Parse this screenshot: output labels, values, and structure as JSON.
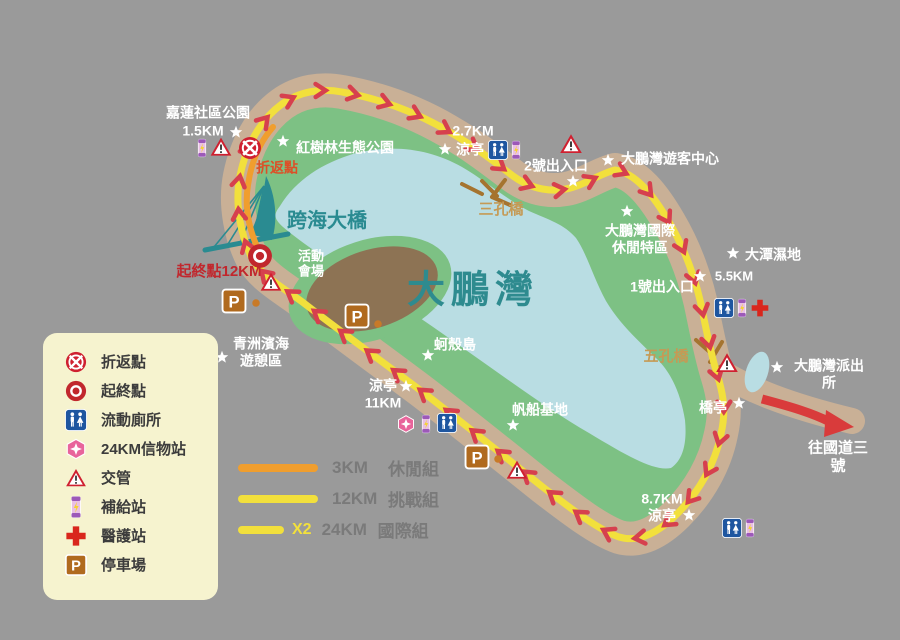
{
  "map": {
    "title": "大鵬灣",
    "colors": {
      "background": "#9a9a9a",
      "road": "#c9b096",
      "land": "#7dc184",
      "water": "#b9dde3",
      "route_12km": "#f2e03c",
      "route_3km": "#f09e2e",
      "chevron": "#d6404e",
      "legend_bg": "#f6f3cf",
      "venue": "#8d7354",
      "teal_text": "#2a8b91",
      "bridge_text": "#c59a55",
      "red_text": "#c1272d"
    }
  },
  "legend": {
    "items": [
      {
        "icon": "noentry",
        "label": "折返點"
      },
      {
        "icon": "startend",
        "label": "起終點"
      },
      {
        "icon": "toilet",
        "label": "流動廁所"
      },
      {
        "icon": "gem",
        "label": "24KM信物站"
      },
      {
        "icon": "warning",
        "label": "交管"
      },
      {
        "icon": "battery",
        "label": "補給站"
      },
      {
        "icon": "cross",
        "label": "醫護站"
      },
      {
        "icon": "parking",
        "label": "停車場"
      }
    ]
  },
  "route_legend": {
    "rows": [
      {
        "dist": "3KM",
        "group": "休閒組",
        "style": "orange"
      },
      {
        "dist": "12KM",
        "group": "挑戰組",
        "style": "yellow"
      },
      {
        "dist": "24KM",
        "group": "國際組",
        "style": "yellow",
        "multiplier": "X2"
      }
    ]
  },
  "labels": [
    {
      "text": "嘉蓮社區公園",
      "x": 208,
      "y": 113,
      "fs": 14,
      "c": "#ffffff"
    },
    {
      "text": "1.5KM",
      "x": 203,
      "y": 131,
      "fs": 14,
      "c": "#ffffff"
    },
    {
      "text": "紅樹林生態公園",
      "x": 345,
      "y": 148,
      "fs": 14,
      "c": "#ffffff"
    },
    {
      "text": "折返點",
      "x": 277,
      "y": 168,
      "fs": 14,
      "c": "#dd4f27"
    },
    {
      "text": "跨海大橋",
      "x": 327,
      "y": 222,
      "fs": 20,
      "c": "#2a8b91"
    },
    {
      "text": "起終點12KM",
      "x": 219,
      "y": 272,
      "fs": 15,
      "c": "#c1272d"
    },
    {
      "text": "活動\n會場",
      "x": 311,
      "y": 264,
      "fs": 13,
      "c": "#ffffff"
    },
    {
      "text": "青洲濱海\n遊憩區",
      "x": 261,
      "y": 352,
      "fs": 14,
      "c": "#ffffff"
    },
    {
      "text": "涼亭\n11KM",
      "x": 383,
      "y": 394,
      "fs": 14,
      "c": "#ffffff"
    },
    {
      "text": "蚵殼島",
      "x": 455,
      "y": 345,
      "fs": 14,
      "c": "#ffffff"
    },
    {
      "text": "大鵬灣",
      "x": 473,
      "y": 291,
      "fs": 38,
      "c": "#2e8b8f",
      "ls": 6
    },
    {
      "text": "帆船基地",
      "x": 540,
      "y": 410,
      "fs": 14,
      "c": "#ffffff"
    },
    {
      "text": "2.7KM",
      "x": 473,
      "y": 131,
      "fs": 14,
      "c": "#ffffff"
    },
    {
      "text": "涼亭",
      "x": 470,
      "y": 150,
      "fs": 14,
      "c": "#ffffff"
    },
    {
      "text": "三孔橋",
      "x": 501,
      "y": 210,
      "fs": 15,
      "c": "#c59a55"
    },
    {
      "text": "2號出入口",
      "x": 556,
      "y": 166,
      "fs": 14,
      "c": "#ffffff"
    },
    {
      "text": "大鵬灣遊客中心",
      "x": 670,
      "y": 159,
      "fs": 14,
      "c": "#ffffff"
    },
    {
      "text": "大鵬灣國際\n休閒特區",
      "x": 640,
      "y": 239,
      "fs": 14,
      "c": "#ffffff"
    },
    {
      "text": "大潭濕地",
      "x": 773,
      "y": 255,
      "fs": 14,
      "c": "#ffffff"
    },
    {
      "text": "5.5KM",
      "x": 734,
      "y": 276,
      "fs": 13,
      "c": "#ffffff"
    },
    {
      "text": "1號出入口",
      "x": 662,
      "y": 287,
      "fs": 14,
      "c": "#ffffff"
    },
    {
      "text": "五孔橋",
      "x": 666,
      "y": 357,
      "fs": 15,
      "c": "#c59a55"
    },
    {
      "text": "大鵬灣派出所",
      "x": 829,
      "y": 374,
      "fs": 14,
      "c": "#ffffff"
    },
    {
      "text": "橋亭",
      "x": 713,
      "y": 408,
      "fs": 14,
      "c": "#ffffff"
    },
    {
      "text": "往國道三號",
      "x": 838,
      "y": 457,
      "fs": 15,
      "c": "#ffffff"
    },
    {
      "text": "8.7KM\n涼亭",
      "x": 662,
      "y": 507,
      "fs": 14,
      "c": "#ffffff"
    }
  ],
  "icons": [
    {
      "type": "battery",
      "x": 202,
      "y": 148,
      "s": 20
    },
    {
      "type": "warning",
      "x": 221,
      "y": 147,
      "s": 23
    },
    {
      "type": "noentry",
      "x": 250,
      "y": 148,
      "s": 24
    },
    {
      "type": "startend",
      "x": 260,
      "y": 256,
      "s": 26
    },
    {
      "type": "warning",
      "x": 271,
      "y": 282,
      "s": 23
    },
    {
      "type": "parking",
      "x": 234,
      "y": 301,
      "s": 25
    },
    {
      "type": "dot",
      "x": 256,
      "y": 303,
      "s": 9
    },
    {
      "type": "parking",
      "x": 357,
      "y": 316,
      "s": 25
    },
    {
      "type": "dot",
      "x": 378,
      "y": 324,
      "s": 9
    },
    {
      "type": "toilet",
      "x": 498,
      "y": 150,
      "s": 20
    },
    {
      "type": "battery",
      "x": 516,
      "y": 150,
      "s": 20
    },
    {
      "type": "warning",
      "x": 571,
      "y": 144,
      "s": 24
    },
    {
      "type": "toilet",
      "x": 724,
      "y": 308,
      "s": 20
    },
    {
      "type": "battery",
      "x": 742,
      "y": 308,
      "s": 20
    },
    {
      "type": "cross",
      "x": 760,
      "y": 308,
      "s": 19
    },
    {
      "type": "warning",
      "x": 727,
      "y": 363,
      "s": 24
    },
    {
      "type": "gem",
      "x": 406,
      "y": 424,
      "s": 19
    },
    {
      "type": "battery",
      "x": 426,
      "y": 424,
      "s": 20
    },
    {
      "type": "toilet",
      "x": 447,
      "y": 423,
      "s": 20
    },
    {
      "type": "parking",
      "x": 477,
      "y": 457,
      "s": 25
    },
    {
      "type": "dot",
      "x": 498,
      "y": 459,
      "s": 9
    },
    {
      "type": "warning",
      "x": 517,
      "y": 470,
      "s": 23
    },
    {
      "type": "toilet",
      "x": 732,
      "y": 528,
      "s": 20
    },
    {
      "type": "battery",
      "x": 750,
      "y": 528,
      "s": 20
    },
    {
      "type": "star",
      "x": 236,
      "y": 132,
      "s": 15
    },
    {
      "type": "star",
      "x": 283,
      "y": 141,
      "s": 15
    },
    {
      "type": "star",
      "x": 445,
      "y": 149,
      "s": 15
    },
    {
      "type": "star",
      "x": 573,
      "y": 181,
      "s": 15
    },
    {
      "type": "star",
      "x": 608,
      "y": 160,
      "s": 15
    },
    {
      "type": "star",
      "x": 627,
      "y": 211,
      "s": 15
    },
    {
      "type": "star",
      "x": 733,
      "y": 253,
      "s": 15
    },
    {
      "type": "star",
      "x": 700,
      "y": 276,
      "s": 15
    },
    {
      "type": "star",
      "x": 777,
      "y": 367,
      "s": 15
    },
    {
      "type": "star",
      "x": 739,
      "y": 403,
      "s": 15
    },
    {
      "type": "star",
      "x": 428,
      "y": 355,
      "s": 15
    },
    {
      "type": "star",
      "x": 513,
      "y": 425,
      "s": 15
    },
    {
      "type": "star",
      "x": 406,
      "y": 386,
      "s": 15
    },
    {
      "type": "star",
      "x": 689,
      "y": 515,
      "s": 15
    },
    {
      "type": "star",
      "x": 222,
      "y": 357,
      "s": 15
    }
  ]
}
